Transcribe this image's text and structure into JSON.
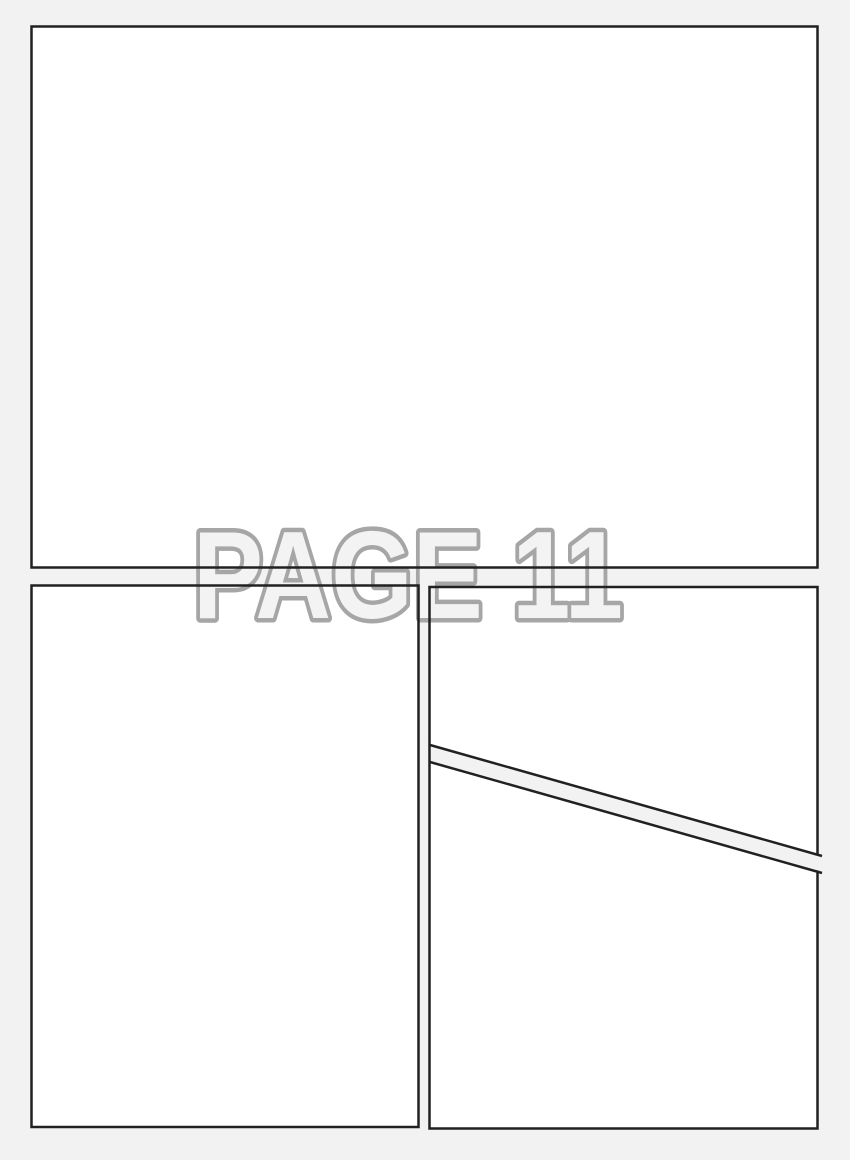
{
  "page": {
    "label": "PAGE 11",
    "colors": {
      "background": "#f2f2f2",
      "panel_fill": "#ffffff",
      "panel_border": "#212121",
      "label_fill": "#f3f3f3",
      "label_outline": "#a6a6a6"
    },
    "panels": [
      {
        "id": "panel-top"
      },
      {
        "id": "panel-bottom-left"
      },
      {
        "id": "panel-bottom-right-upper"
      },
      {
        "id": "panel-bottom-right-lower"
      }
    ]
  }
}
